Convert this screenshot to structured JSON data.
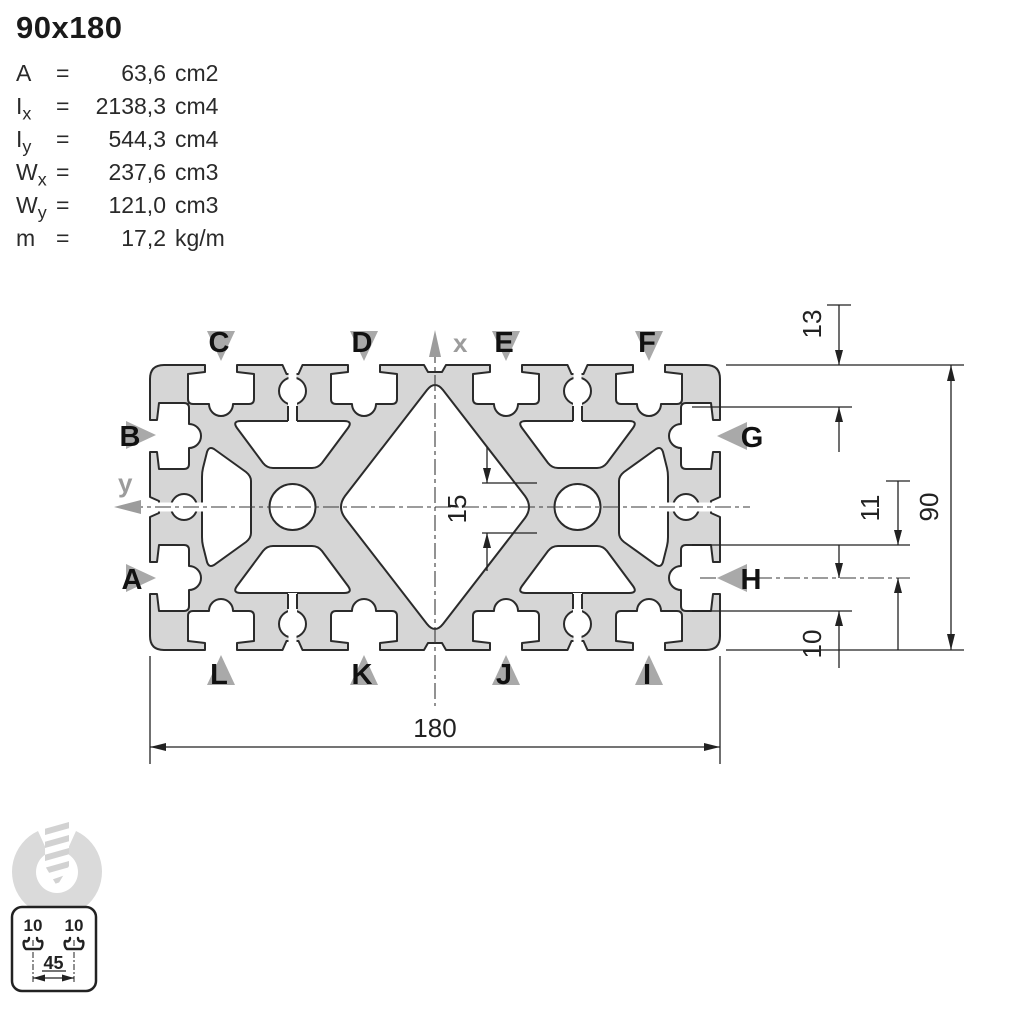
{
  "header": {
    "title": "90x180"
  },
  "properties": [
    {
      "symbol": "A",
      "sub": "",
      "eq": "=",
      "value": "63,6",
      "unit": "cm2"
    },
    {
      "symbol": "I",
      "sub": "x",
      "eq": "=",
      "value": "2138,3",
      "unit": "cm4"
    },
    {
      "symbol": "I",
      "sub": "y",
      "eq": "=",
      "value": "544,3",
      "unit": "cm4"
    },
    {
      "symbol": "W",
      "sub": "x",
      "eq": "=",
      "value": "237,6",
      "unit": "cm3"
    },
    {
      "symbol": "W",
      "sub": "y",
      "eq": "=",
      "value": "121,0",
      "unit": "cm3"
    },
    {
      "symbol": "m",
      "sub": "",
      "eq": "=",
      "value": "17,2",
      "unit": "kg/m"
    }
  ],
  "drawing": {
    "slot_labels": {
      "top": [
        "C",
        "D",
        "E",
        "F"
      ],
      "bottom": [
        "L",
        "K",
        "J",
        "I"
      ],
      "left": [
        "B",
        "A"
      ],
      "right": [
        "G",
        "H"
      ]
    },
    "axis_labels": {
      "x": "x",
      "y": "y"
    },
    "dimensions": {
      "width": "180",
      "height": "90",
      "top_edge_to_slot": "13",
      "slot_center_upper": "11",
      "slot_center_lower": "10",
      "core_channel": "15"
    },
    "colors": {
      "profile_fill": "#d6d6d6",
      "outline": "#2b2b2b",
      "label_triangle": "#a9a9a9",
      "axis_gray": "#9c9c9c",
      "watermark": "#dadada"
    }
  },
  "legend_icon": {
    "slot_left": "10",
    "slot_right": "10",
    "pitch": "45"
  }
}
